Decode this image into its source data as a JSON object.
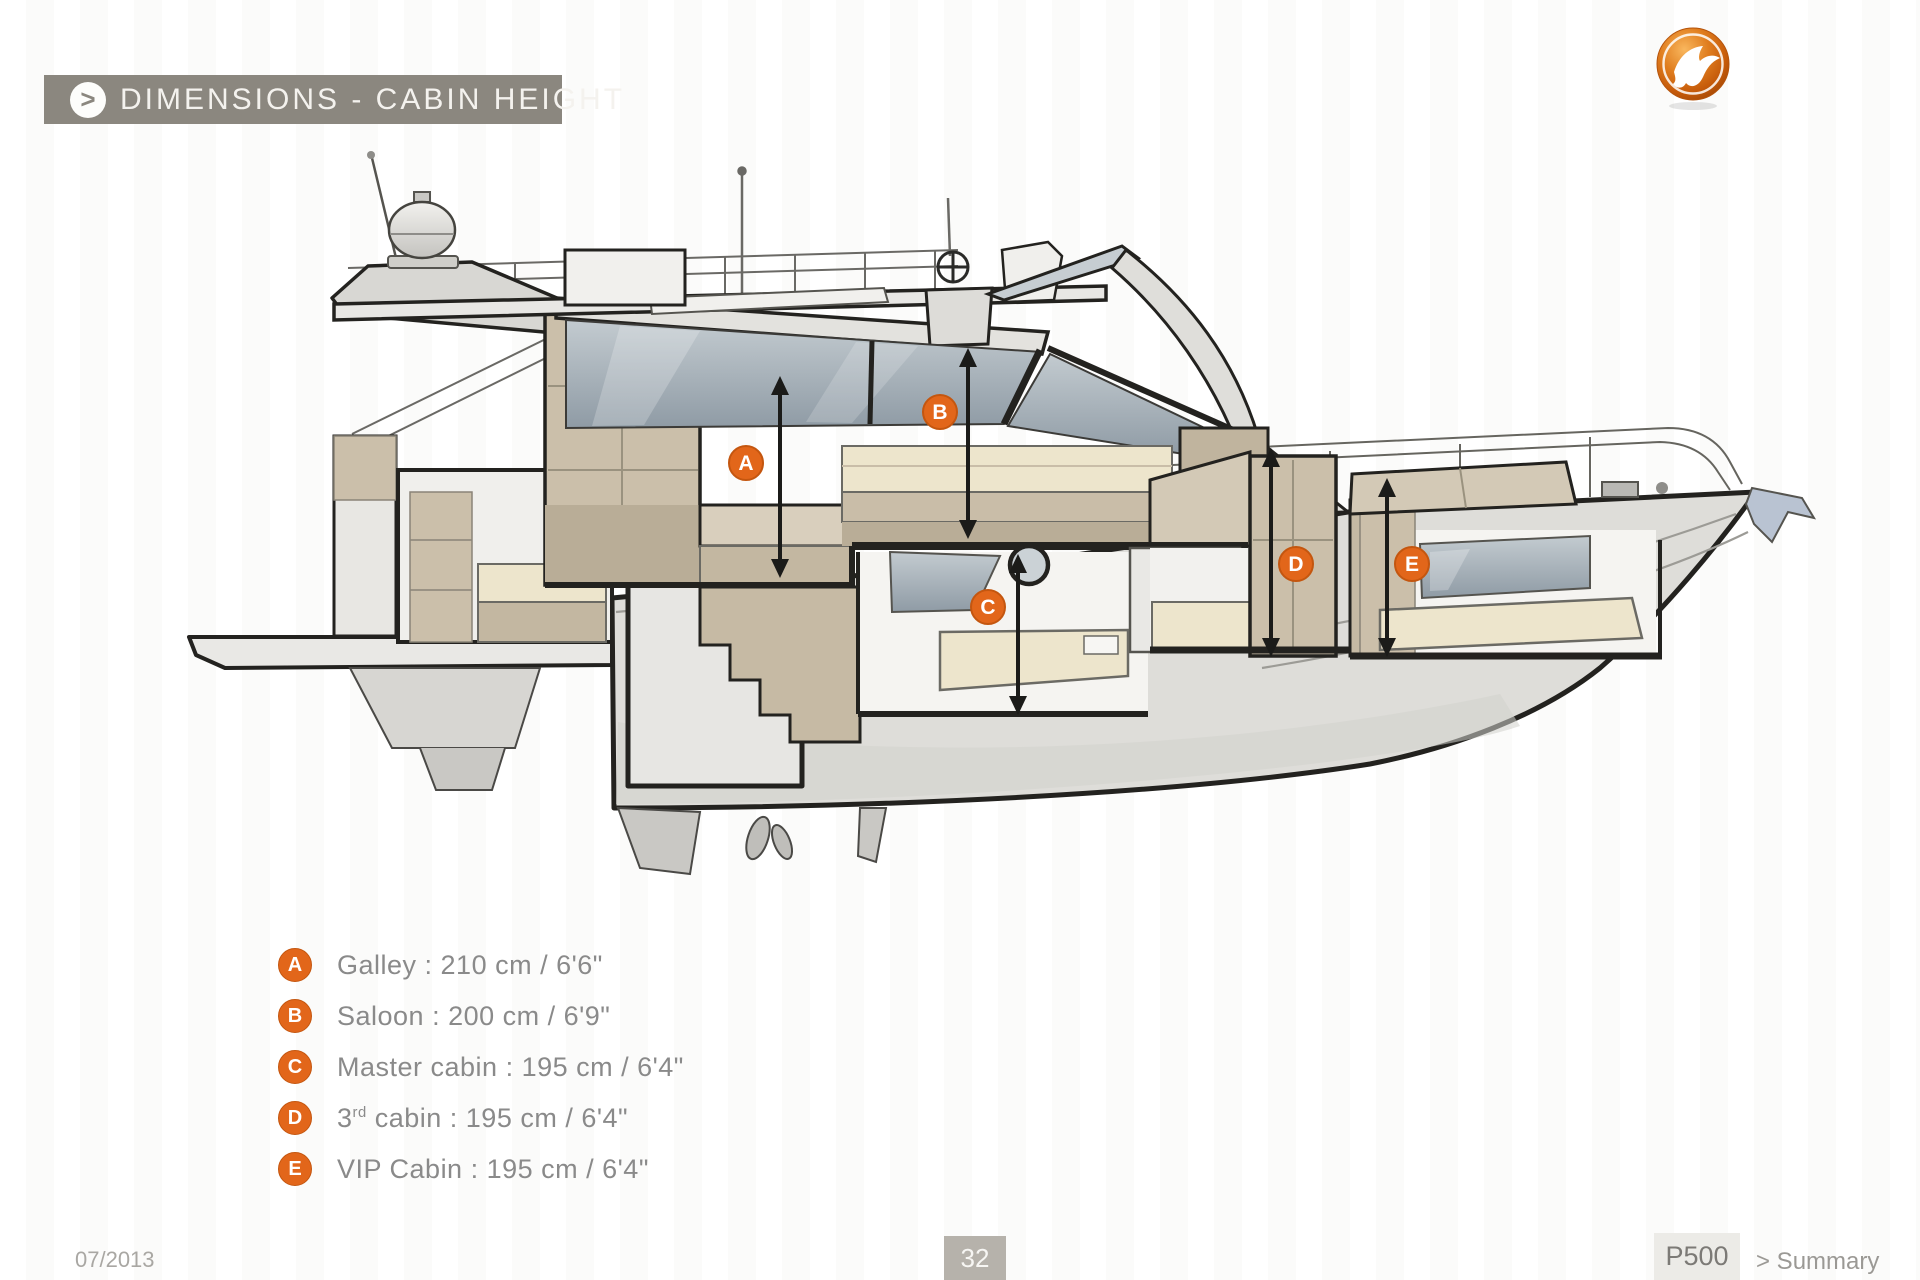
{
  "theme": {
    "accent_orange": "#e2661a",
    "header_bar_gray": "#8b877f",
    "outline_ink": "#23221f"
  },
  "header": {
    "chevron": ">",
    "title": "DIMENSIONS - CABIN HEIGHT"
  },
  "brand": {
    "logo_icon": "seabird-logo"
  },
  "diagram": {
    "markers": [
      {
        "letter": "A"
      },
      {
        "letter": "B"
      },
      {
        "letter": "C"
      },
      {
        "letter": "D"
      },
      {
        "letter": "E"
      }
    ]
  },
  "legend": {
    "items": [
      {
        "id": "A",
        "pre": "Galley : 210 cm / 6'6\"",
        "sup": "",
        "post": ""
      },
      {
        "id": "B",
        "pre": "Saloon : 200 cm / 6'9\"",
        "sup": "",
        "post": ""
      },
      {
        "id": "C",
        "pre": "Master cabin : 195 cm / 6'4\"",
        "sup": "",
        "post": ""
      },
      {
        "id": "D",
        "pre": "3",
        "sup": "rd",
        "post": " cabin : 195 cm / 6'4\""
      },
      {
        "id": "E",
        "pre": "VIP Cabin : 195 cm / 6'4\"",
        "sup": "",
        "post": ""
      }
    ]
  },
  "footer": {
    "date": "07/2013",
    "page_number": "32",
    "model": "P500",
    "summary": "> Summary"
  }
}
